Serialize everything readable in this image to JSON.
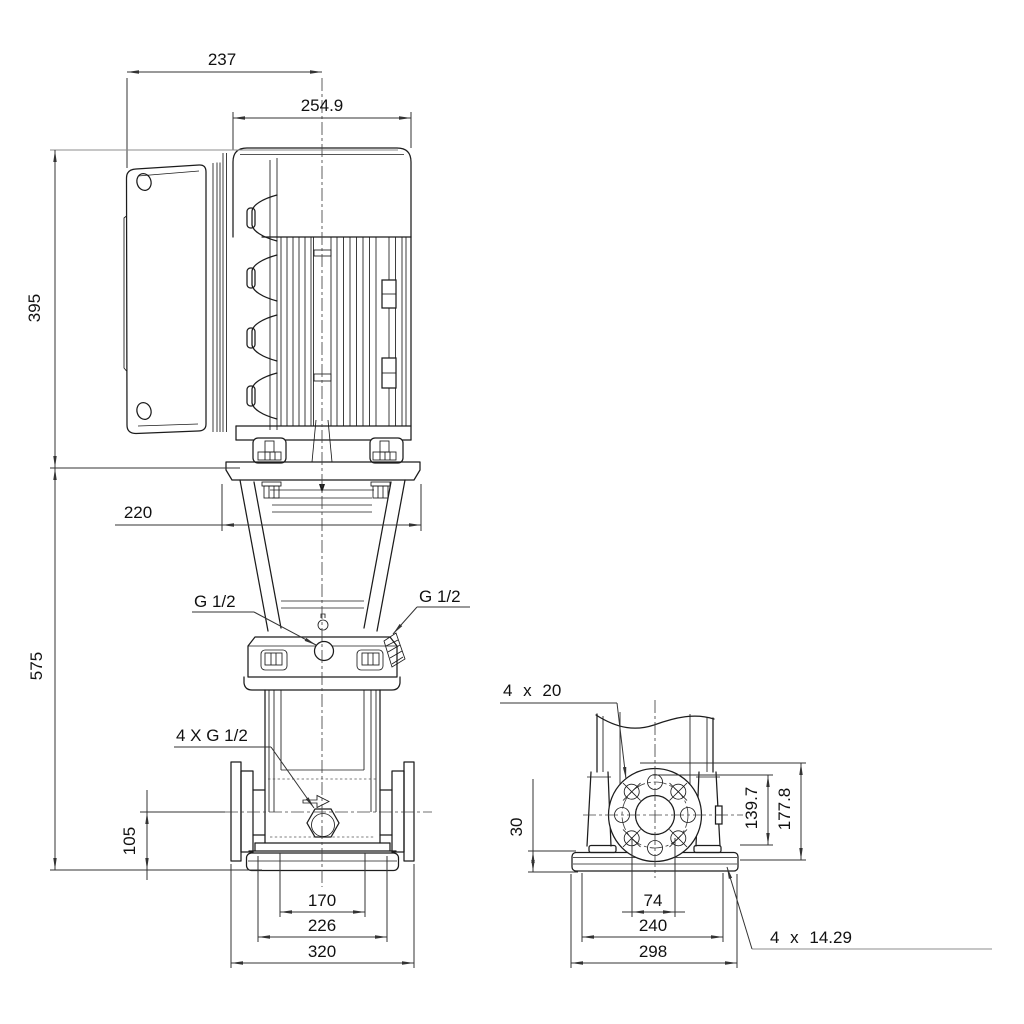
{
  "drawing": {
    "type": "pump-dimensional-drawing",
    "colors": {
      "line": "#1c1c1c",
      "dimension": "#333333",
      "light": "#8c8c8c",
      "background": "#ffffff",
      "text": "#111111"
    }
  },
  "front": {
    "d237": "237",
    "d2549": "254.9",
    "d395": "395",
    "d220": "220",
    "g12_left": "G 1/2",
    "g12_right": "G 1/2",
    "g12_4x": "4 X G 1/2",
    "d105": "105",
    "d575": "575",
    "d170": "170",
    "d226": "226",
    "d320": "320"
  },
  "side": {
    "d4x20": "4 x 20",
    "d30": "30",
    "d1397": "139.7",
    "d1778": "177.8",
    "d74": "74",
    "d240": "240",
    "d298": "298",
    "d4x1429": "4 x 14.29"
  }
}
